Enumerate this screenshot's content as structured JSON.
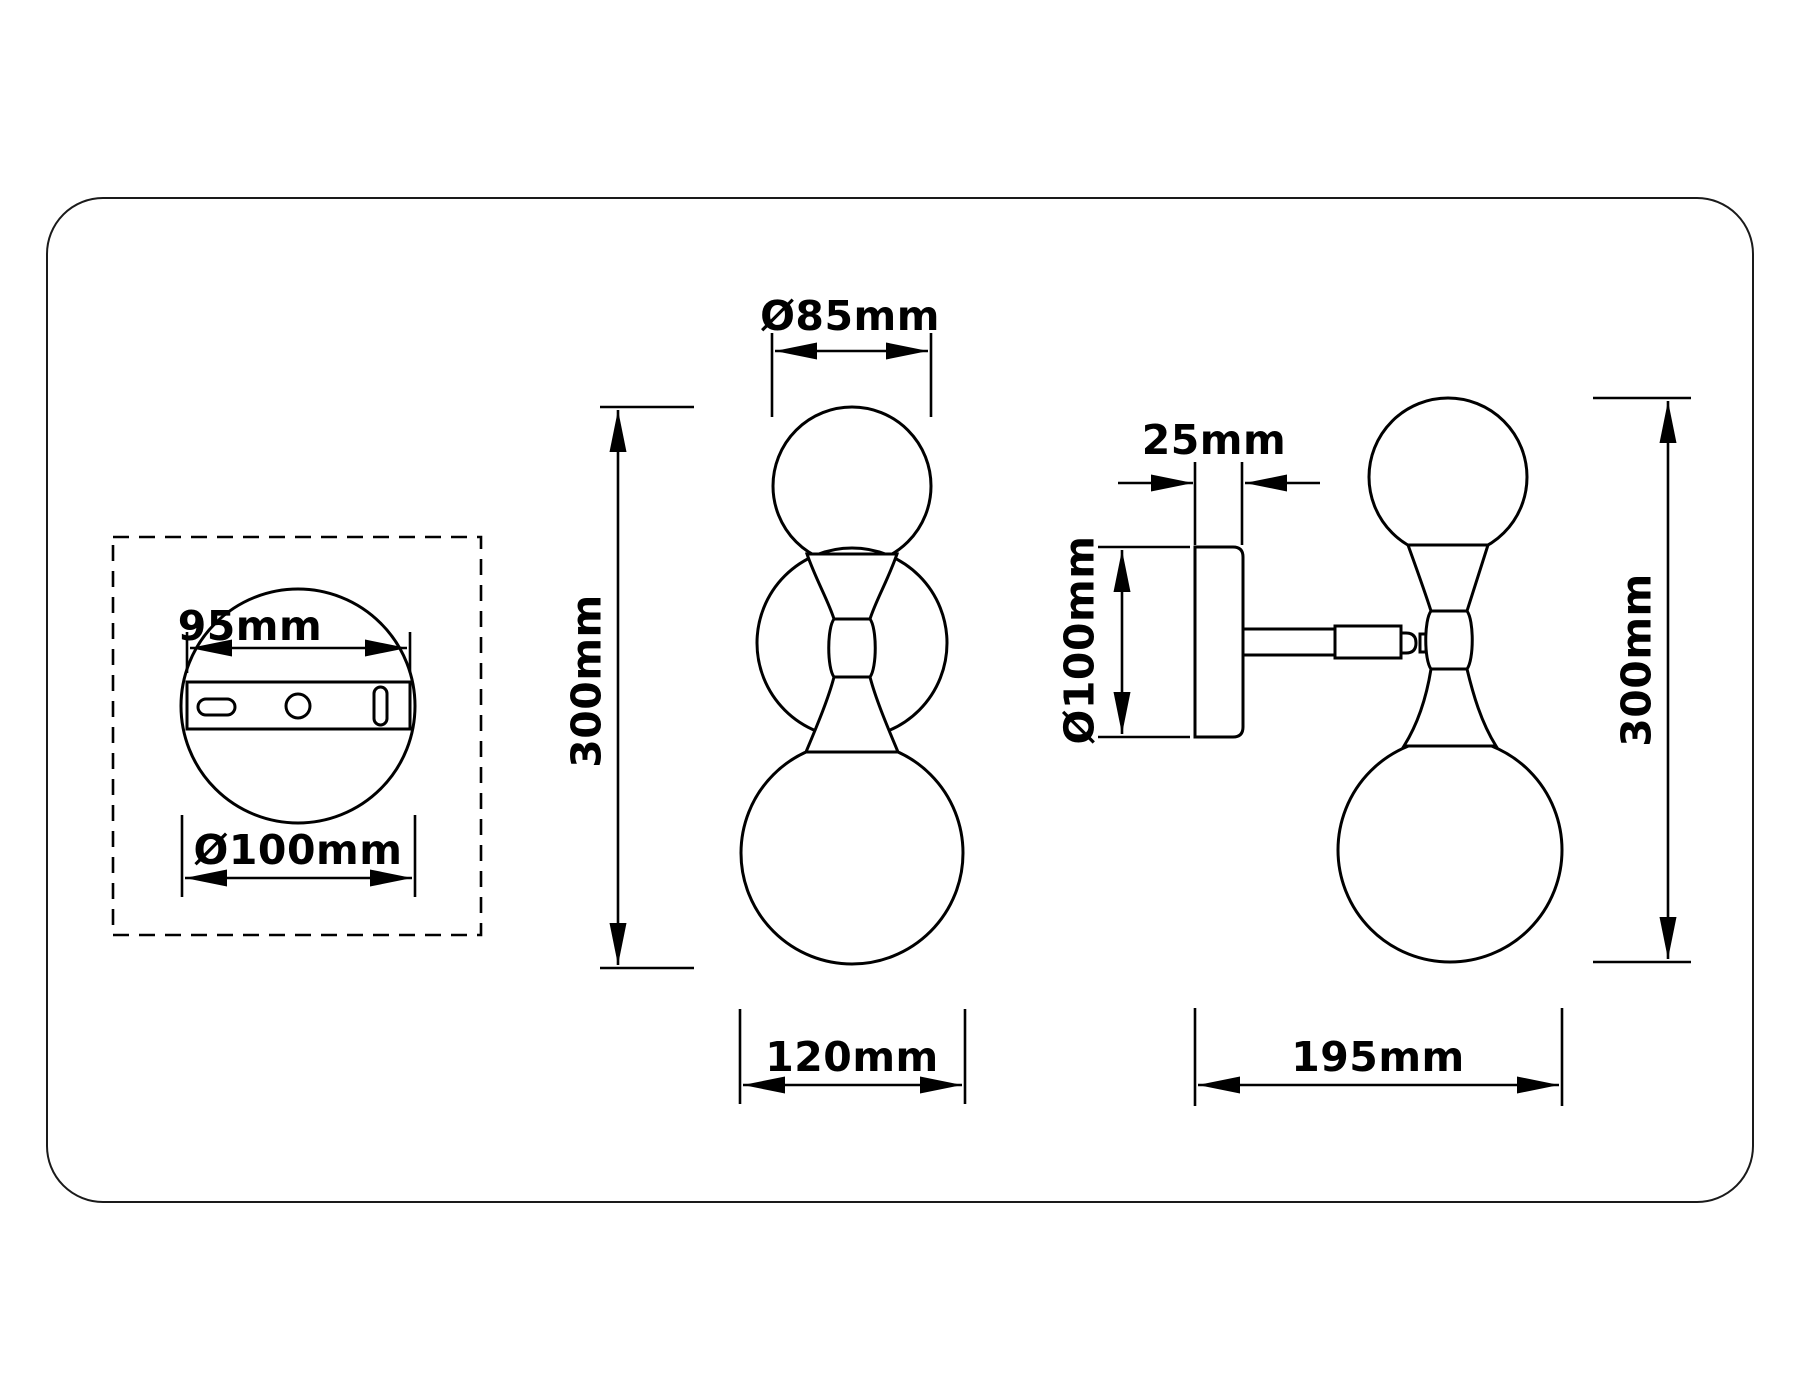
{
  "drawing": {
    "type": "technical dimension drawing",
    "subject": "wall sconce lamp with two glass globes",
    "colors": {
      "line": "#000000",
      "background": "#ffffff",
      "border": "#1a1a1a"
    },
    "views": {
      "mounting_plate": {
        "name": "mounting-plate-rear-view",
        "dimensions": {
          "bracket_width": "95mm",
          "plate_diameter": "Ø100mm"
        }
      },
      "front": {
        "name": "front-view",
        "dimensions": {
          "globe_diameter": "Ø85mm",
          "height": "300mm",
          "width": "120mm"
        }
      },
      "side": {
        "name": "side-view",
        "dimensions": {
          "plate_thickness": "25mm",
          "plate_diameter": "Ø100mm",
          "height": "300mm",
          "depth": "195mm"
        }
      }
    }
  }
}
